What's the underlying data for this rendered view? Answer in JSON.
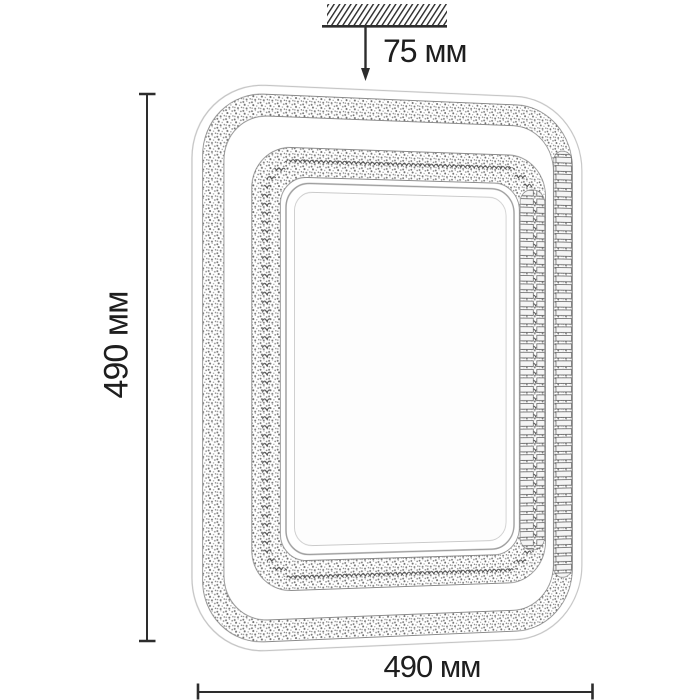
{
  "page": {
    "background": "#ffffff"
  },
  "annotations": {
    "top_dimension": {
      "label": "75 мм"
    },
    "left_dimension": {
      "label": "490 мм"
    },
    "bottom_dimension": {
      "label": "490 мм"
    }
  },
  "icons": {
    "ceiling_mount": "ceiling-hatch-icon",
    "offset_arrow": "arrow-down-icon",
    "vertical_extent": "dimension-line-vertical",
    "horizontal_extent": "dimension-line-horizontal"
  },
  "figure": {
    "parts": [
      "fixture-outer-contour",
      "fixture-outer-crystal-band",
      "fixture-inner-crystal-band",
      "fixture-side-crystal-band",
      "fixture-center-panel"
    ]
  },
  "colors": {
    "line": "#2d2d2d",
    "text": "#1e1e1e",
    "contour": "#c4c4c4",
    "band_edge": "#8a8a8a"
  }
}
